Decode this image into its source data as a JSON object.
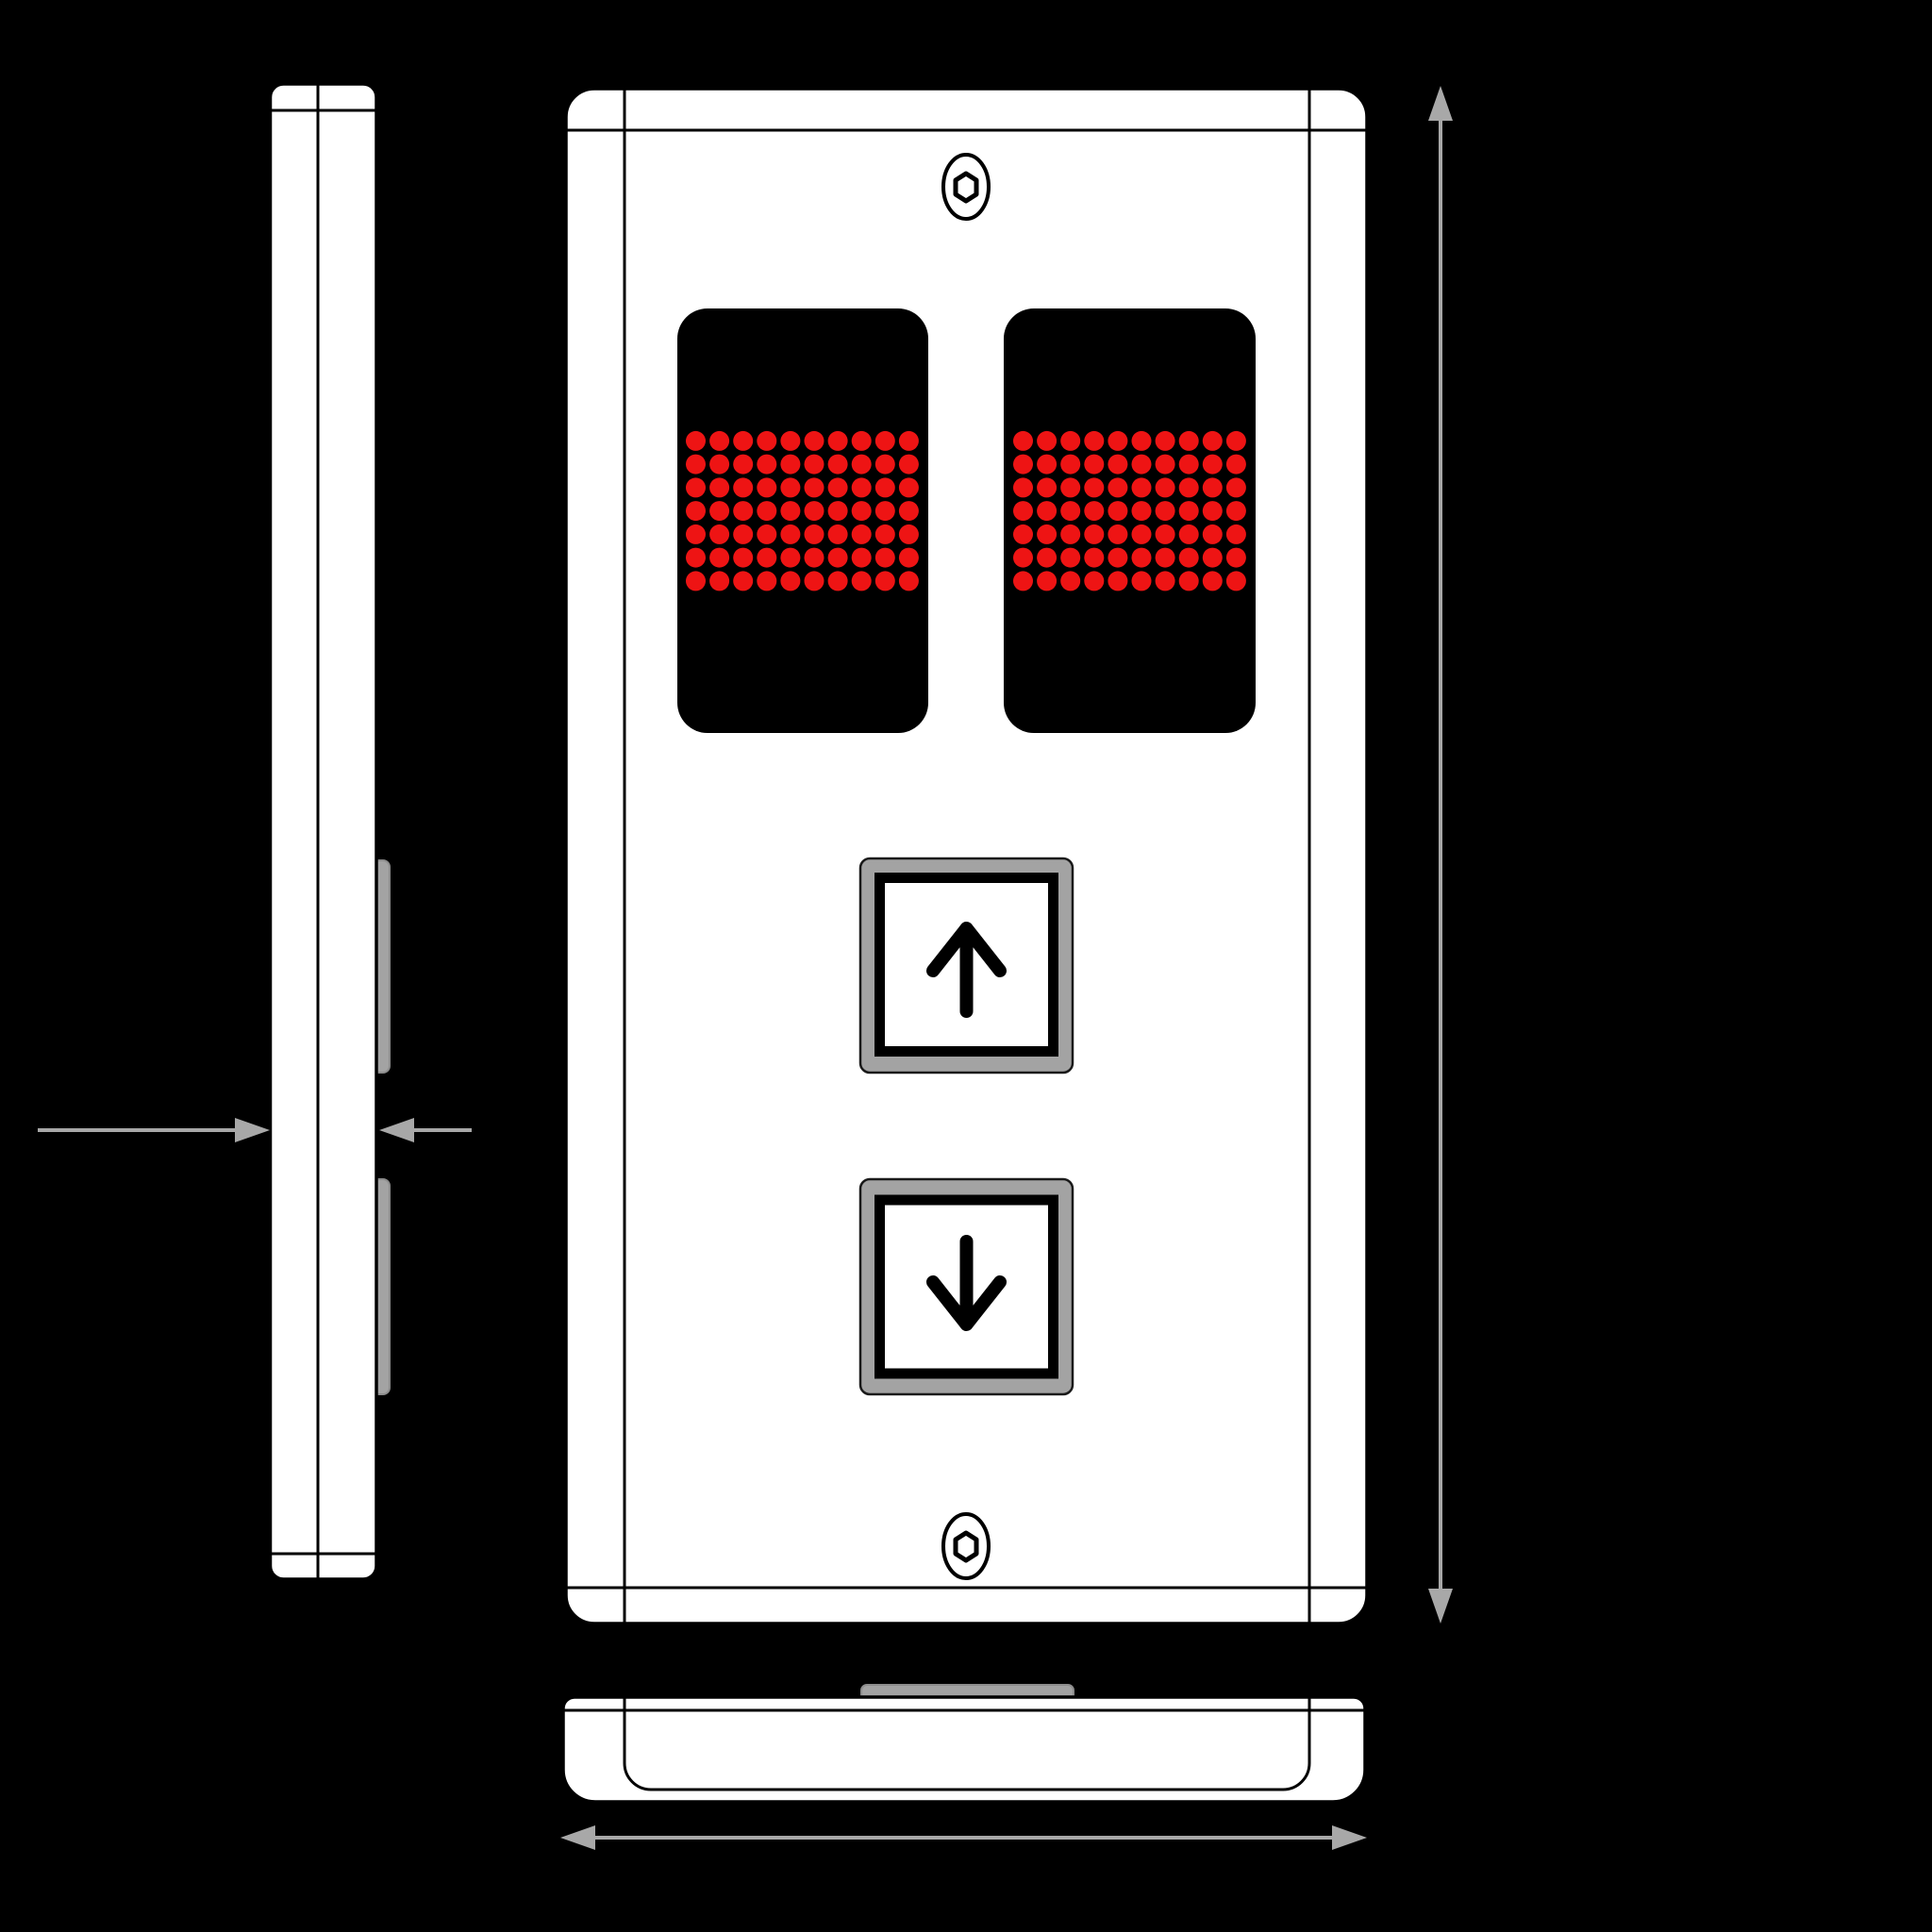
{
  "drawing": {
    "subject": "elevator-hall-call-panel",
    "views": {
      "side_view": "side profile with two protruding button tabs",
      "front_view": "face plate with two LED dot-matrix displays, up button, down button, two hex-socket screws",
      "bottom_view": "bottom profile with mounting tab"
    }
  },
  "dimensions": {
    "thickness": "20 mm",
    "height": "280 mm",
    "width": "150 mm"
  },
  "led_display": {
    "panels": 2,
    "rows": 7,
    "cols": 10,
    "dot_color": "#ee1414",
    "state": "all dots lit"
  },
  "buttons": [
    {
      "id": "up",
      "symbol": "up-arrow"
    },
    {
      "id": "down",
      "symbol": "down-arrow"
    }
  ],
  "colors": {
    "background": "#000000",
    "panel": "#ffffff",
    "line": "#000000",
    "dimension": "#a8a8a8",
    "button": "#a3a3a3",
    "button_border": "#1a1a1a",
    "tab_border": "#8c8c8c",
    "led_bg": "#000000",
    "label": "#000000"
  }
}
